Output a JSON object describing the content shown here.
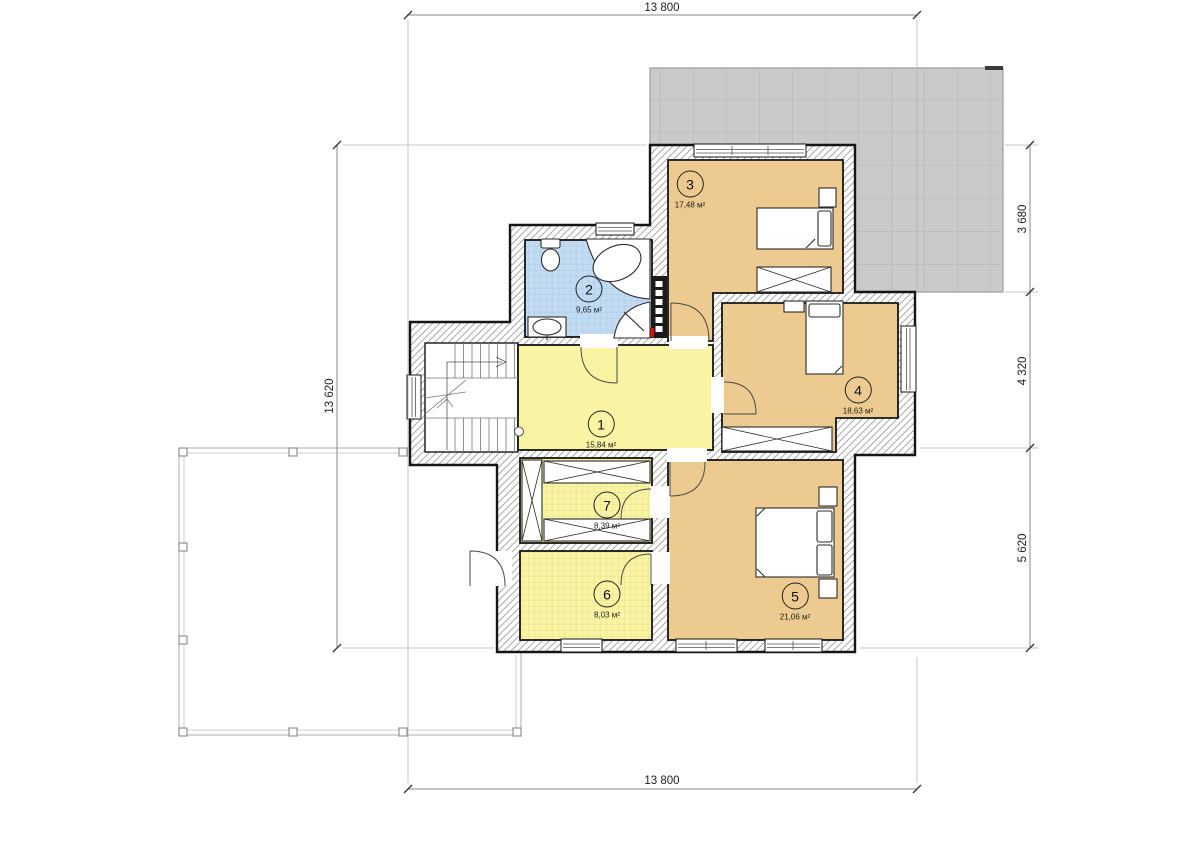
{
  "plan_title": "floor-plan",
  "dimensions": {
    "top": "13 800",
    "bottom": "13 800",
    "left": "13 620",
    "right_top": "3 680",
    "right_middle": "4 320",
    "right_bottom": "5 620"
  },
  "rooms": [
    {
      "number": "1",
      "area": "15,84 м²"
    },
    {
      "number": "2",
      "area": "9,65 м²"
    },
    {
      "number": "3",
      "area": "17,48 м²"
    },
    {
      "number": "4",
      "area": "18,63 м²"
    },
    {
      "number": "5",
      "area": "21,06 м²"
    },
    {
      "number": "6",
      "area": "8,03 м²"
    },
    {
      "number": "7",
      "area": "8,39 м²"
    }
  ],
  "colors": {
    "bedroom_fill": "#edca8f",
    "hall_fill": "#f8f4a3",
    "bath_fill": "#c2dbf2",
    "roof_fill": "#cacaca",
    "wall_line": "#151515",
    "accent_red": "#e01010"
  }
}
